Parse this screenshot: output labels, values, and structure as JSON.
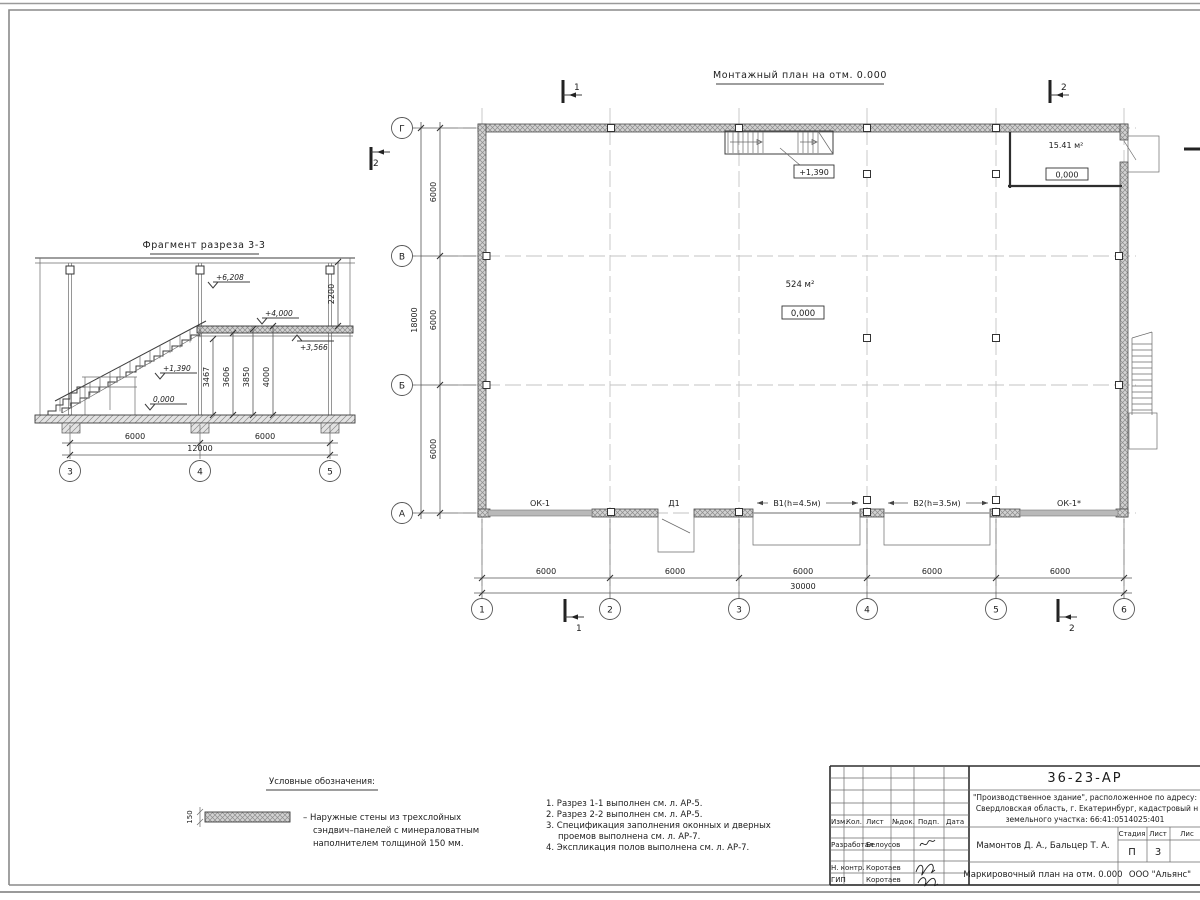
{
  "plan": {
    "title": "Монтажный план на отм. 0.000",
    "area_main": "524 м²",
    "level_main": "0,000",
    "area_room": "15.41 м²",
    "level_room": "0,000",
    "stair_elev": "+1,390",
    "openings": {
      "ok1": "ОК-1",
      "d1": "Д1",
      "v1": "В1(h=4.5м)",
      "v2": "В2(h=3.5м)",
      "ok1s": "ОК-1*"
    },
    "dim_bay": "6000",
    "dim_total_x": "30000",
    "dim_total_y": "18000",
    "axes_num": [
      "1",
      "2",
      "3",
      "4",
      "5",
      "6"
    ],
    "axes_let": [
      "Г",
      "В",
      "Б",
      "А"
    ],
    "marker1": "1",
    "marker2": "2"
  },
  "section": {
    "title": "Фрагмент разреза 3-3",
    "elev": {
      "e6208": "+6,208",
      "e4000": "+4,000",
      "e3566": "+3,566",
      "e1390": "+1,390",
      "e0": "0,000"
    },
    "vdims": [
      "3467",
      "3606",
      "3850",
      "4000"
    ],
    "vdim_right": "2200",
    "hdim": "6000",
    "hdim_total": "12000",
    "axes": [
      "3",
      "4",
      "5"
    ]
  },
  "legend": {
    "title": "Условные обозначения:",
    "thickness": "150",
    "lines": [
      "–  Наружные стены из трехслойных",
      "сэндвич–панелей с минераловатным",
      "наполнителем толщиной 150 мм."
    ]
  },
  "notes": [
    "1. Разрез 1-1 выполнен см. л. АР-5.",
    "2. Разрез 2-2 выполнен см. л. АР-5.",
    "3. Спецификация заполнения оконных и дверных",
    "проемов выполнена см. л. АР-7.",
    "4. Экспликация полов выполнена см. л. АР-7."
  ],
  "titleblock": {
    "code": "36-23-АР",
    "project1": "\"Производственное здание\", расположенное по адресу:",
    "project2": "Свердловская область, г. Екатеринбург, кадастровый н",
    "project3": "земельного участка: 66:41:0514025:401",
    "col_izm": "Изм.",
    "col_kol": "Кол.",
    "col_list": "Лист",
    "col_ndok": "№док.",
    "col_podp": "Подп.",
    "col_data": "Дата",
    "row1_role": "Разработал",
    "row1_name": "Белоусов",
    "row2_role": "Н. контр.",
    "row2_name": "Коротаев",
    "row3_role": "ГИП",
    "row3_name": "Коротаев",
    "authors": "Мамонтов Д. А., Бальцер Т. А.",
    "stage_label": "Стадия",
    "list_label": "Лист",
    "lists_label": "Лис",
    "stage": "П",
    "list_num": "3",
    "doc_name": "Маркировочный план на отм. 0.000",
    "org": "ООО \"Альянс\""
  }
}
